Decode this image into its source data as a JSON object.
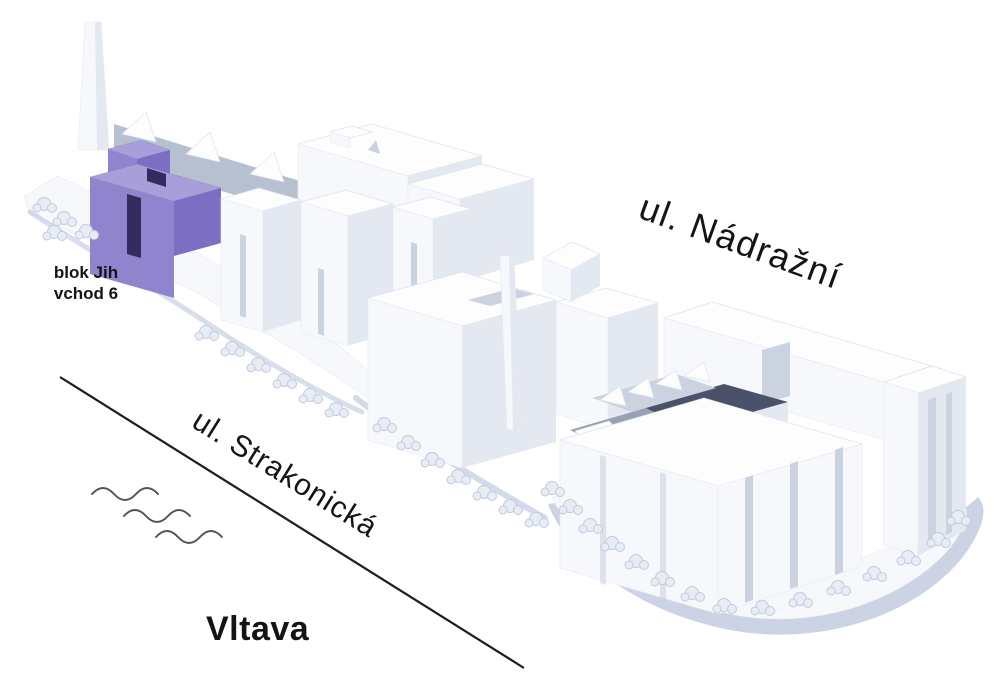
{
  "labels": {
    "block": {
      "line1": "blok Jih",
      "line2": "vchod 6"
    },
    "street_top": "ul. Nádražní",
    "street_riverside": "ul. Strakonická",
    "river": "Vltava"
  },
  "icons": {
    "water_waves": "three-wavy-lines",
    "street_edge": "diagonal-line"
  },
  "colors": {
    "background": "#ffffff",
    "label_text": "#141417",
    "street_line": "#1d1d1f",
    "wave_stroke": "#55565c",
    "highlight_purple": "#9184cf",
    "highlight_purple_light": "#a99eda",
    "highlight_purple_dark": "#7b6ec3",
    "highlight_recess": "#332a5e",
    "face_top": "#fdfdfe",
    "face_front": "#f7f8fb",
    "face_side_light": "#e4e8f1",
    "face_side_mid": "#ccd3e0",
    "face_shed_grey": "#b7c0d1",
    "courtyard_shadow": "#4b5168",
    "shadow_blue": "#aab6d4",
    "tree_fill": "#e8ecf4",
    "tree_stroke": "#c2cbdc"
  }
}
